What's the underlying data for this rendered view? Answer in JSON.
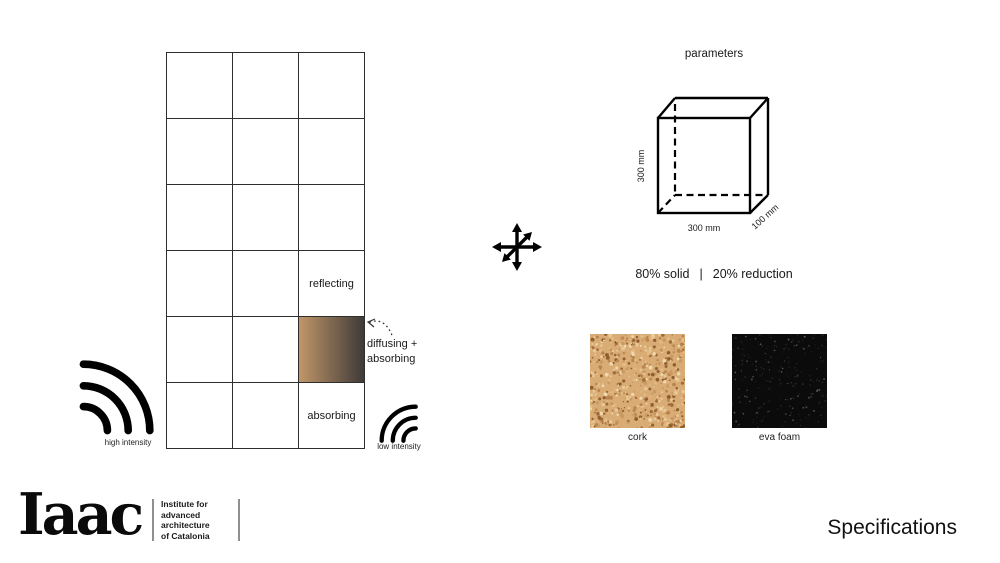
{
  "slide": {
    "background": "#ffffff",
    "line_color": "#1a1a1a"
  },
  "acoustic_grid": {
    "rows": 6,
    "columns": 3,
    "reflecting_label": "reflecting",
    "absorbing_label": "absorbing",
    "diffusing_label_line1": "diffusing +",
    "diffusing_label_line2": "absorbing",
    "gradient_cell": {
      "color_left": "#c09668",
      "color_right": "#3e3a38"
    },
    "high_intensity_label": "high intensity",
    "low_intensity_label": "low intensity"
  },
  "parameters": {
    "title": "parameters",
    "cube": {
      "height": "300 mm",
      "width": "300 mm",
      "depth": "100 mm"
    },
    "solid": "80% solid",
    "separator": "|",
    "reduction": "20% reduction",
    "materials": [
      {
        "name": "cork",
        "base_color": "#d9ab75",
        "speckle_colors": [
          "#b9854e",
          "#e8c894",
          "#a06b38",
          "#f0d8ae",
          "#c89a62",
          "#8f5f2f",
          "#e2b981"
        ],
        "speckle_count": 620,
        "speckle_min": 0.5,
        "speckle_max": 2.1
      },
      {
        "name": "eva foam",
        "base_color": "#0b0b0b",
        "speckle_colors": [
          "#303030",
          "#484848",
          "#1e1e1e",
          "#5a5a5a",
          "#262626"
        ],
        "speckle_count": 240,
        "speckle_min": 0.3,
        "speckle_max": 1.1
      }
    ]
  },
  "footer": {
    "logo": "Iaac",
    "institute_lines": [
      "Institute for",
      "advanced",
      "architecture",
      "of Catalonia"
    ],
    "slide_label": "Specifications"
  }
}
